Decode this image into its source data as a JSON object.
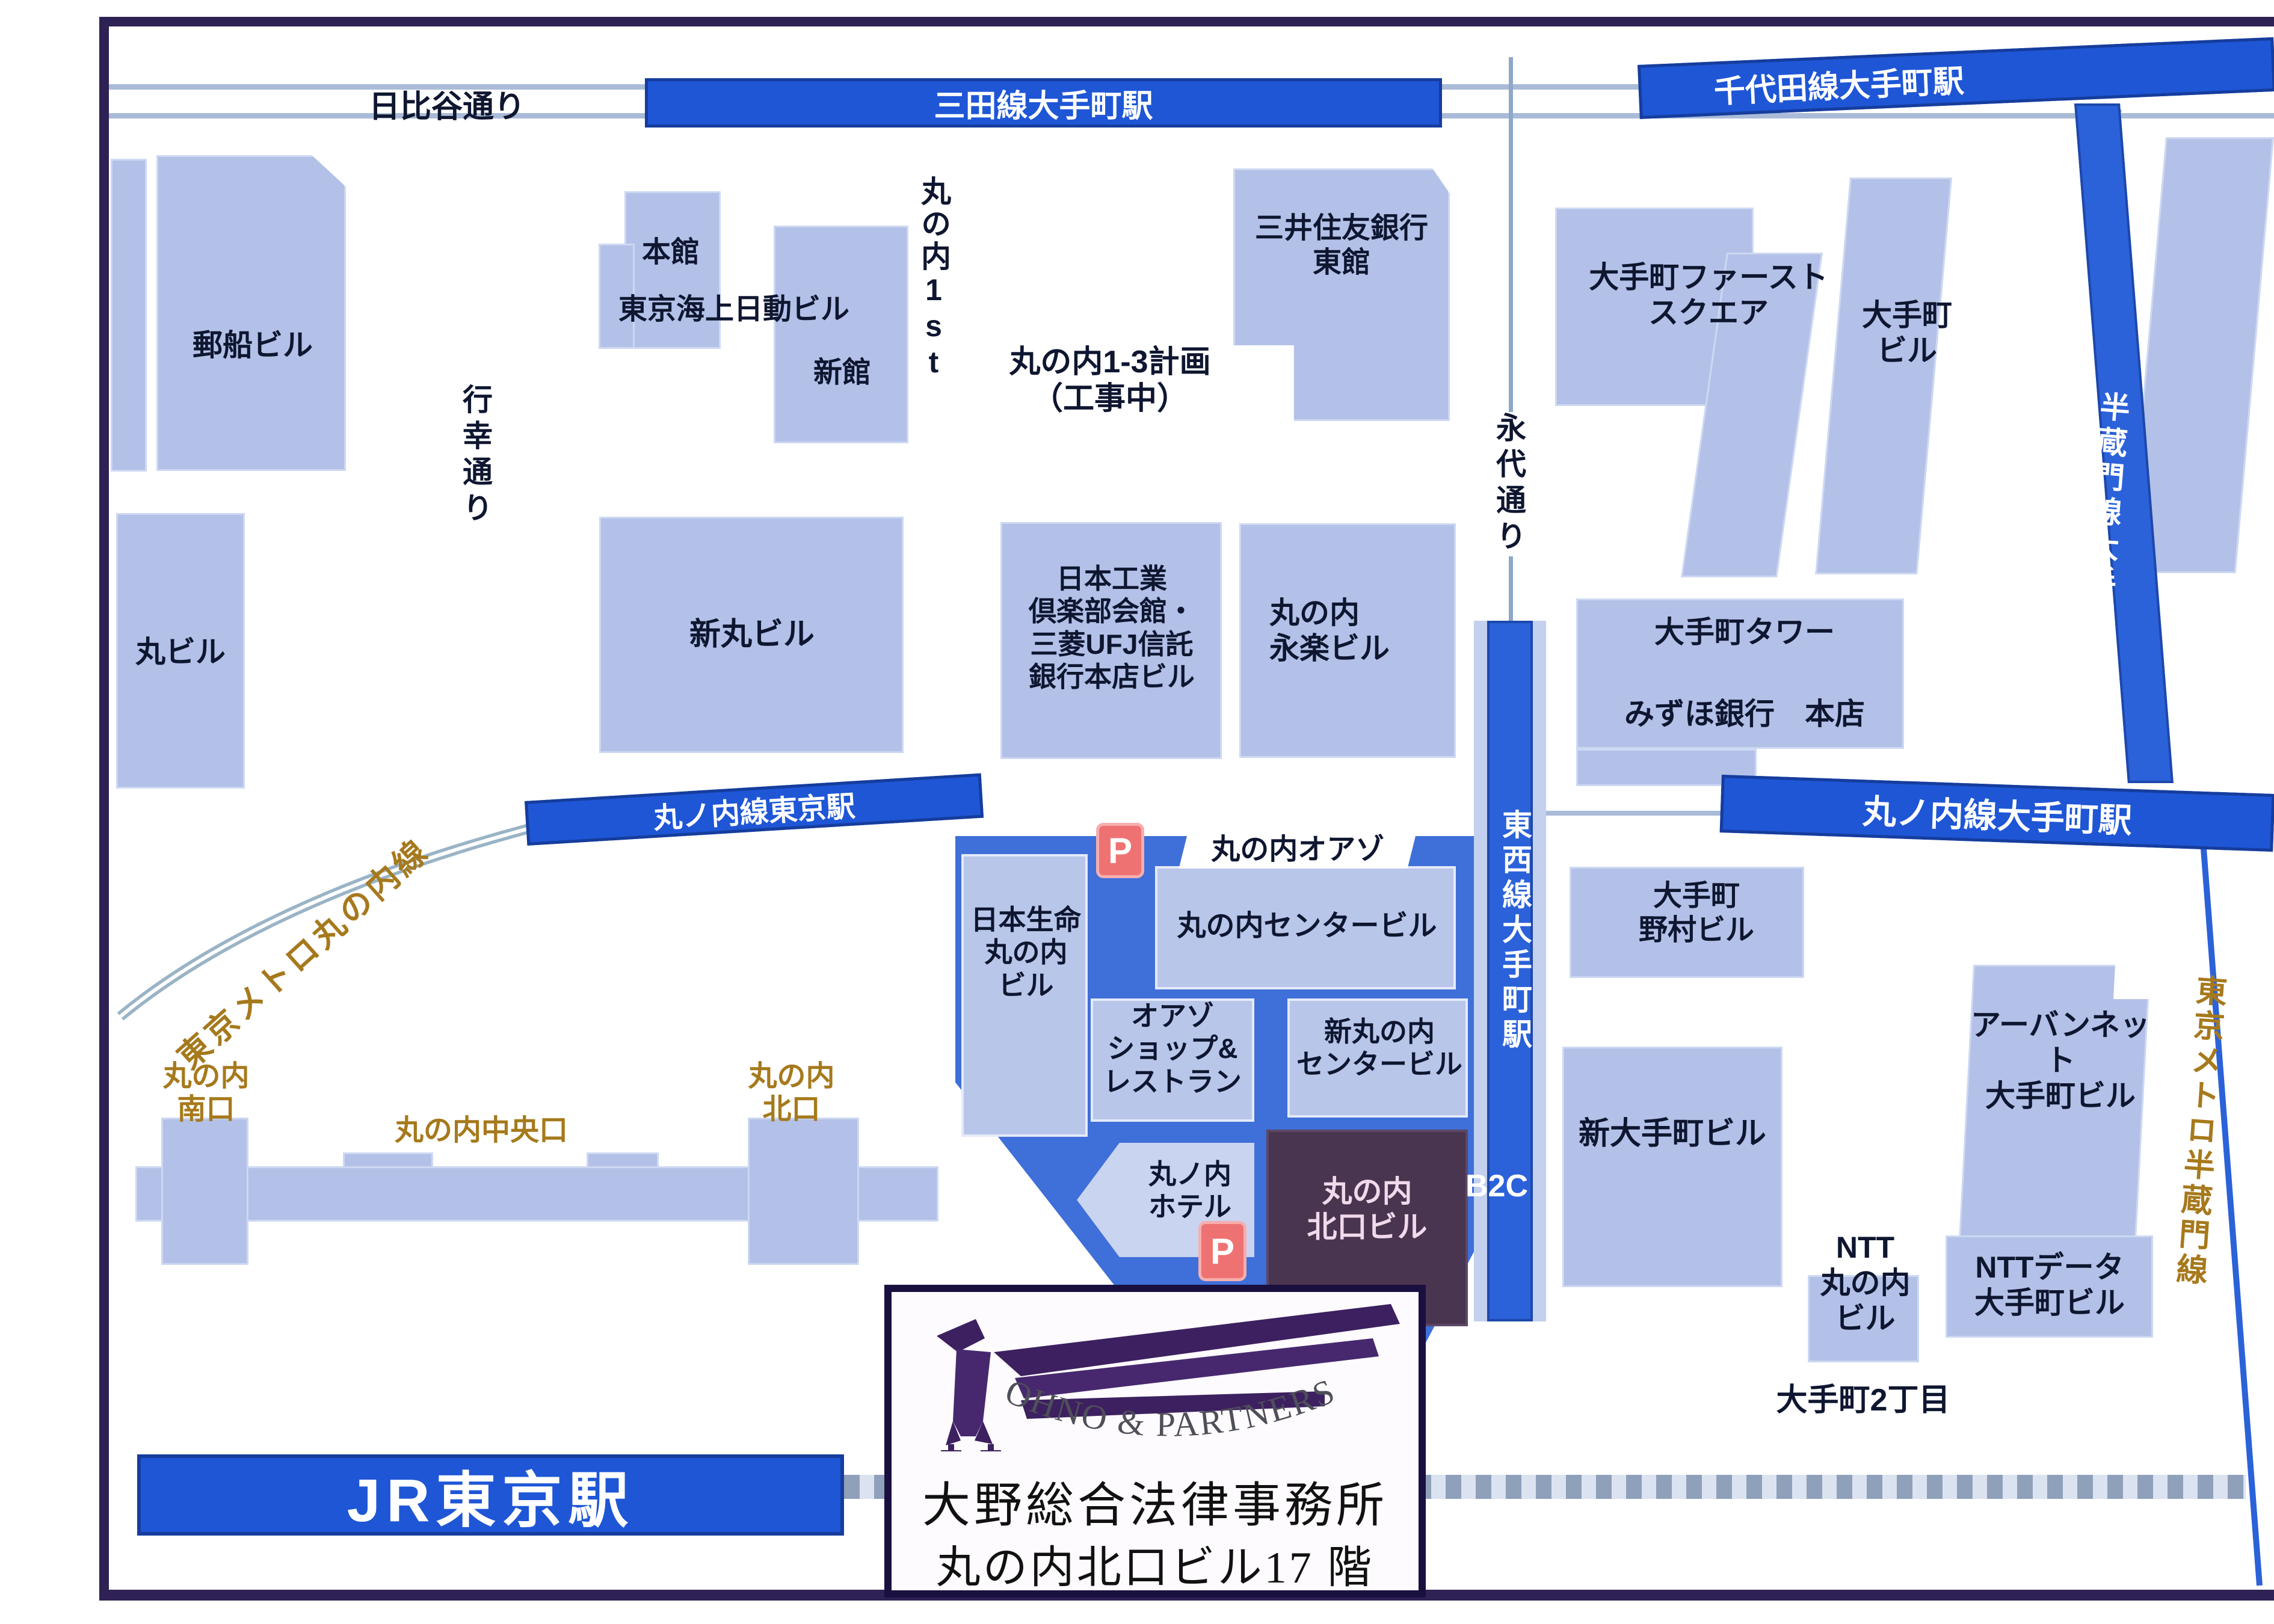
{
  "roads": {
    "hibiya_dori": "日比谷通り",
    "gyoko_dori": "行幸通り",
    "eitai_dori": "永代通り"
  },
  "rail": {
    "mita_line_otemachi": "三田線大手町駅",
    "chiyoda_line_otemachi": "千代田線大手町駅",
    "hanzomon_line_otemachi": "半蔵門線大手町駅",
    "marunouchi_line_tokyo": "丸ノ内線東京駅",
    "marunouchi_line_otemachi": "丸ノ内線大手町駅",
    "tozai_line_otemachi": "東西線大手町駅",
    "tokyo_metro_marunouchi_line": "東京メトロ丸の内線",
    "tokyo_metro_hanzomon_line": "東京メトロ半蔵門線",
    "jr_tokyo_station": "JR東京駅",
    "b2c_exit": "B2C"
  },
  "station_exits": {
    "south": "丸の内\n南口",
    "central": "丸の内中央口",
    "north": "丸の内\n北口"
  },
  "buildings": {
    "yusen": "郵船ビル",
    "marubiru": "丸ビル",
    "honkan": "本館",
    "tokio_marine": "東京海上日動ビル",
    "shinkan": "新館",
    "marunouchi_1st": "丸の内1st",
    "marunouchi_13_plan": "丸の内1-3計画\n（工事中）",
    "smbc_east": "三井住友銀行\n東館",
    "otemachi_first_square": "大手町ファースト\nスクエア",
    "otemachi_bldg": "大手町\nビル",
    "shin_marubiru": "新丸ビル",
    "kogyo_club": "日本工業\n倶楽部会館・\n三菱UFJ信託\n銀行本店ビル",
    "eiraku": "丸の内\n永楽ビル",
    "otemachi_tower": "大手町タワー",
    "mizuho": "みずほ銀行　本店",
    "nomura": "大手町\n野村ビル",
    "shin_otemachi": "新大手町ビル",
    "urbannet": "アーバンネット\n大手町ビル",
    "ntt_marunouchi": "NTT\n丸の内\nビル",
    "ntt_data": "NTTデータ\n大手町ビル",
    "otemachi_2chome": "大手町2丁目",
    "oazo": "丸の内オアゾ",
    "nissei": "日本生命\n丸の内\nビル",
    "center_bldg": "丸の内センタービル",
    "oazo_shop": "オアゾ\nショップ&\nレストラン",
    "shin_center_bldg": "新丸の内\nセンタービル",
    "hotel": "丸ノ内\nホテル",
    "kitaguchi_bldg": "丸の内\n北口ビル"
  },
  "icons": {
    "parking": "P"
  },
  "logo_box": {
    "firm_en": "OHNO & PARTNERS",
    "firm_jp": "大野総合法律事務所",
    "location": "丸の内北口ビル17 階"
  },
  "colors": {
    "line_blue": "#1e56d6",
    "building_fill": "#b3c1e8",
    "oazo_blue": "#3f6fd8",
    "kitaguchi_plum": "#4a3550",
    "gold": "#a6791c",
    "parking_red": "#ee7272",
    "frame_purple": "#2e2153"
  }
}
